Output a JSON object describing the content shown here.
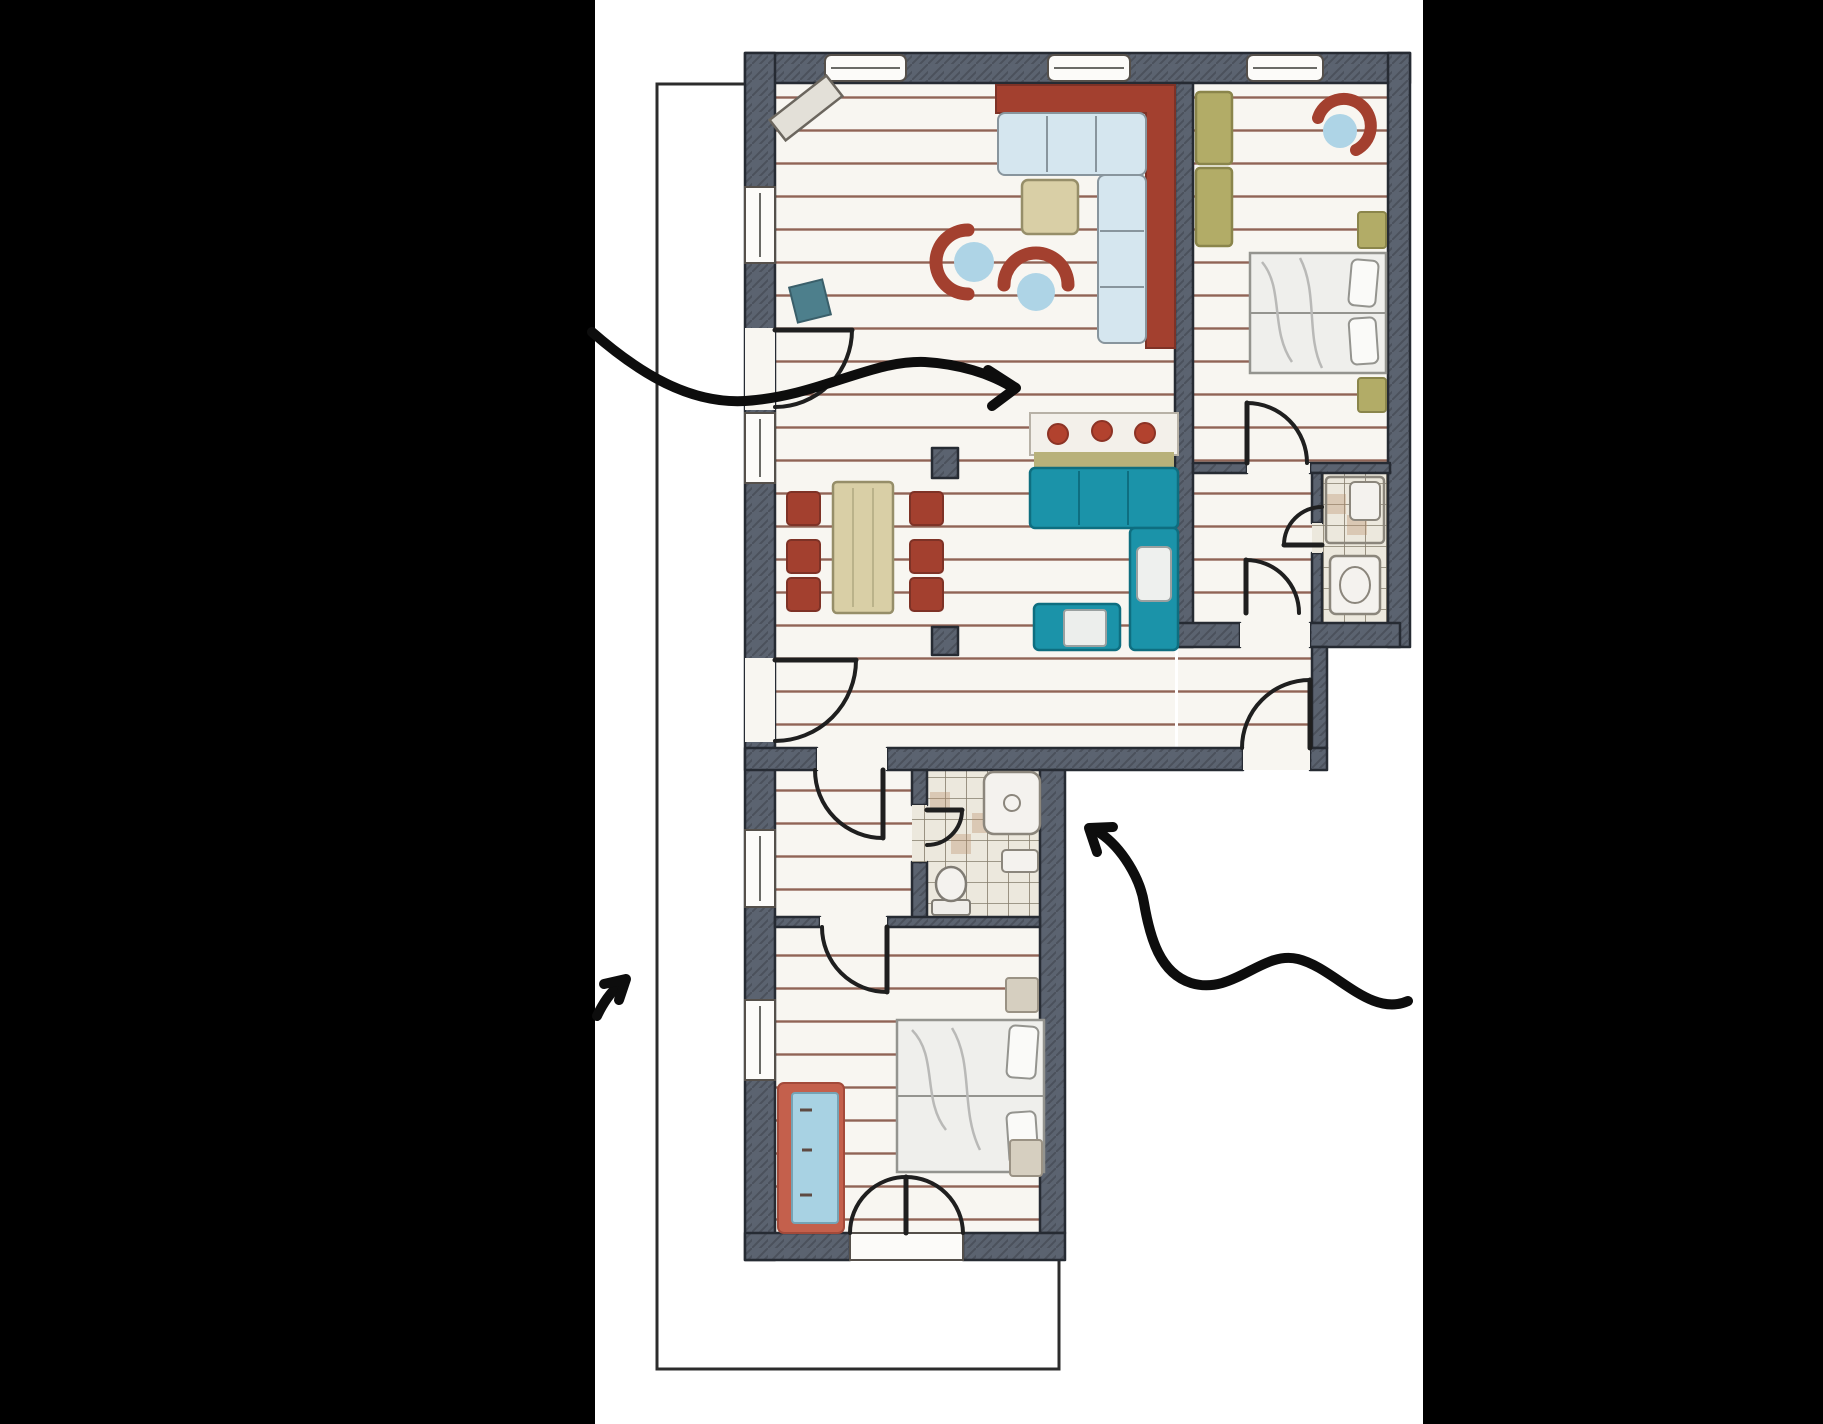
{
  "scene": {
    "kind": "hand-drawn apartment floor plan sketch",
    "rooms": [
      "living-dining-kitchen",
      "bedroom-1",
      "bathroom-1",
      "corridor",
      "hallway",
      "anteroom",
      "bathroom-2",
      "bedroom-2",
      "balcony-outline"
    ],
    "annotations": [
      "arrow-pointing-into-living-area",
      "arrow-pointing-up-at-balcony-side",
      "arrow-pointing-into-lower-unit"
    ]
  },
  "colors": {
    "background": "#000000",
    "canvas": "#ffffff",
    "wall": "#5b6370",
    "wall_line": "#262b33",
    "floor": "#f8f6f1",
    "plank": "#7e4a3a",
    "tile_bg": "#ece8dd",
    "tile_line": "#857d6c",
    "tile_accent": "#b98f6b",
    "outline": "#2c2c2c",
    "door": "#1f1f1f",
    "red": "#a3402f",
    "red_dark": "#7e3226",
    "cushion": "#d5e6ef",
    "cushion_line": "#88959d",
    "seat_blue": "#aed4e6",
    "teal": "#1b93a9",
    "teal_dark": "#0e6e80",
    "olive": "#b2ac67",
    "olive_dark": "#8a854b",
    "tan": "#d9cfa6",
    "tan_dark": "#968e69",
    "board": "#b8b17a",
    "linen": "#efefec",
    "linen_line": "#94948f",
    "fixture": "#f4f2ee",
    "fixture_line": "#8b867c",
    "salmon": "#c4604c",
    "crib_blue": "#a8d2e3",
    "bench": "#e3e0d8",
    "bench_line": "#6b665e",
    "arrow": "#0d0d0d"
  }
}
